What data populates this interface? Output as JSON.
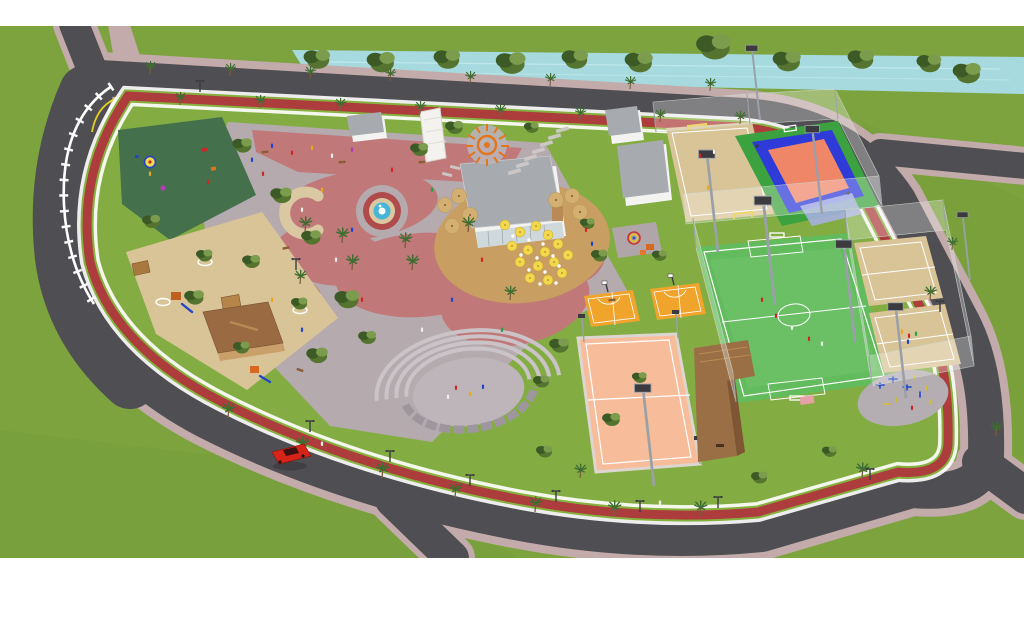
{
  "scene": {
    "type": "3d-aerial-architectural-render",
    "subject": "public-park-and-sports-complex-masterplan",
    "features": [
      "canal-waterway",
      "perimeter-ring-road",
      "running-track-border",
      "white-boundary-fence",
      "rubber-playground",
      "sand-playground",
      "central-plaza",
      "curved-pink-promenade",
      "fountain",
      "palm-tree-rows",
      "canal-tree-row",
      "cafe-building",
      "cafe-terrace-deck",
      "yellow-umbrellas",
      "tan-umbrellas",
      "sun-sculpture",
      "pergola-canopy",
      "stepping-stone-path",
      "restroom-buildings",
      "kids-play-corner",
      "amphitheater",
      "pavilion-kiosk",
      "beach-soccer-court",
      "multisport-court",
      "soccer-field",
      "sand-volleyball-courts",
      "outdoor-gym",
      "basketball-3x3-courts",
      "salmon-sports-court",
      "bleacher-structure",
      "floodlight-poles",
      "street-lamps",
      "red-car",
      "pedestrians",
      "benches",
      "road-markings"
    ],
    "counts_visible": {
      "basketball_3x3_courts": 2,
      "sand_volleyball_courts": 2,
      "cars": 1
    }
  },
  "colors": {
    "canvas": "#ffffff",
    "grass": "#7da33f",
    "grass_park": "#83ad43",
    "grass_dk": "#6d9634",
    "tree": "#55742f",
    "tree_dark": "#3c5a26",
    "tree_light": "#7c9c4d",
    "palm": "#3f6d31",
    "trunk": "#7a5c3e",
    "road": "#4f4e52",
    "sidewalk": "#c3abab",
    "verge": "#86b13f",
    "track": "#ad3d3d",
    "yellow": "#e6cf1f",
    "canal": "#a6dade",
    "canal_hl": "#c6ecef",
    "plaza": "#b5aaae",
    "pink": "#c07878",
    "tan": "#d9c8a2",
    "sand": "#d9c498",
    "rubber": "#44704c",
    "deck": "#c99e62",
    "cafe": "#f3f3f1",
    "roof": "#a7abb0",
    "glass": "#cfd9dc",
    "field": "#62bb5c",
    "line": "#ffffff",
    "court_orange": "#f0a42c",
    "court_salmon": "#f7bd9a",
    "court_blue": "#2f3bd8",
    "court_green": "#3ca23f",
    "court_center": "#f08668",
    "apron": "#aab0e8",
    "gym": "#b4aeb2",
    "amph_floor": "#bdb5b9",
    "amph_step": "#cac3c7",
    "amph_wall": "#9d979d",
    "pav": "#9a6b42",
    "pav_ridge": "#b98a55",
    "struct": "#9b6f45",
    "struct_dk": "#7e5634",
    "fence": "#ffffff",
    "pole": "#9aa0a8",
    "lamp": "#3b3b3f",
    "car": "#d62419",
    "car_glass": "#3a1010",
    "water": "#45b5d8",
    "umb_y": "#f2d84e",
    "umb_t": "#d3b071",
    "sculpt": "#e2761f",
    "goal": "#e8c832",
    "bench": "#8a5c3a",
    "stone": "#cfc9c9",
    "p_blue": "#2244cc",
    "p_red": "#cc2626",
    "p_white": "#efefef",
    "p_yellow": "#e8a81e",
    "p_green": "#28a044",
    "p_magenta": "#b43cb4"
  }
}
